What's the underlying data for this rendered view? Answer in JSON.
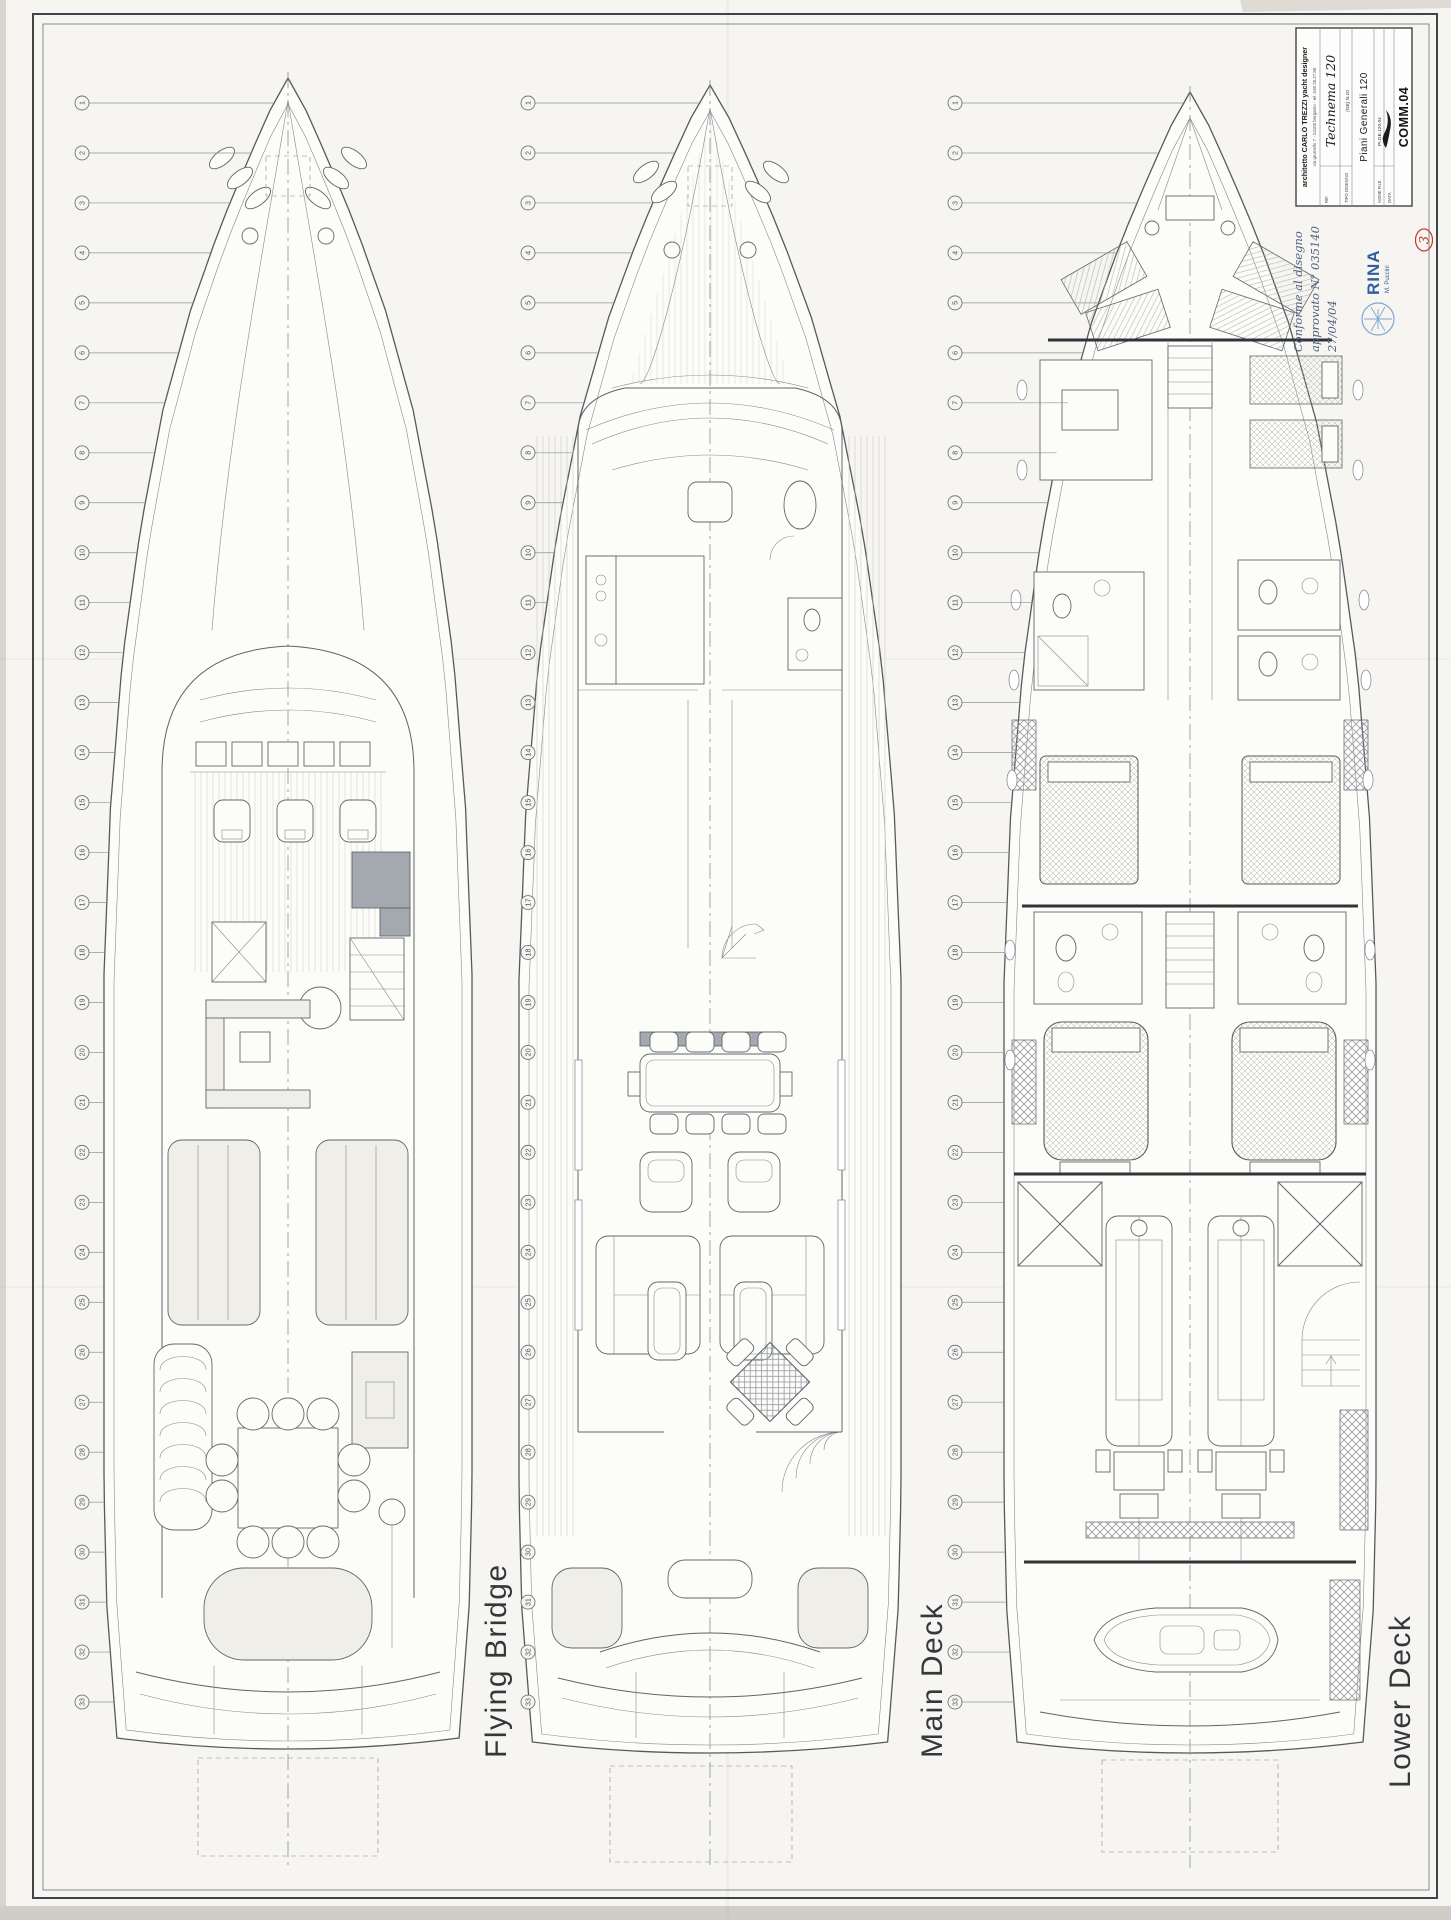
{
  "sheet": {
    "decks": [
      {
        "id": "flying-bridge",
        "label": "Flying Bridge"
      },
      {
        "id": "main-deck",
        "label": "Main Deck"
      },
      {
        "id": "lower-deck",
        "label": "Lower Deck"
      }
    ],
    "stations": {
      "numbers": [
        1,
        2,
        3,
        4,
        5,
        6,
        7,
        8,
        9,
        10,
        11,
        12,
        13,
        14,
        15,
        16,
        17,
        18,
        19,
        20,
        21,
        22,
        23,
        24,
        25,
        26,
        27,
        28,
        29,
        30,
        31,
        32,
        33,
        34
      ]
    },
    "title_block": {
      "architect_line": "architetto CARLO TREZZI yacht designer",
      "address_line": "via grumello 7  -  24100 bergamo  -  tel. 035 25.27.86",
      "ref_label": "RIF.",
      "project_script": "Technema 120",
      "type_label": "TIPO DISEGNO",
      "type_value": "(GE) N.10",
      "drawing_title": "Piani Generali 120",
      "file_label": "NOME FILE",
      "file_value": "PI.GE.120.04",
      "date_label": "DATA",
      "commission": "COMM.04"
    },
    "approval_note": {
      "line1": "Conforme al disegno",
      "line2": "approvato N° 035140",
      "line3": "27/04/04"
    },
    "stamp": {
      "org": "RINA",
      "sub": "M. Puccini"
    },
    "page_mark": "3",
    "colors": {
      "paper": "#f6f5f1",
      "line": "#5f646b",
      "stamp_blue": "#2f5f9e",
      "pen_red": "#c0392b"
    }
  }
}
